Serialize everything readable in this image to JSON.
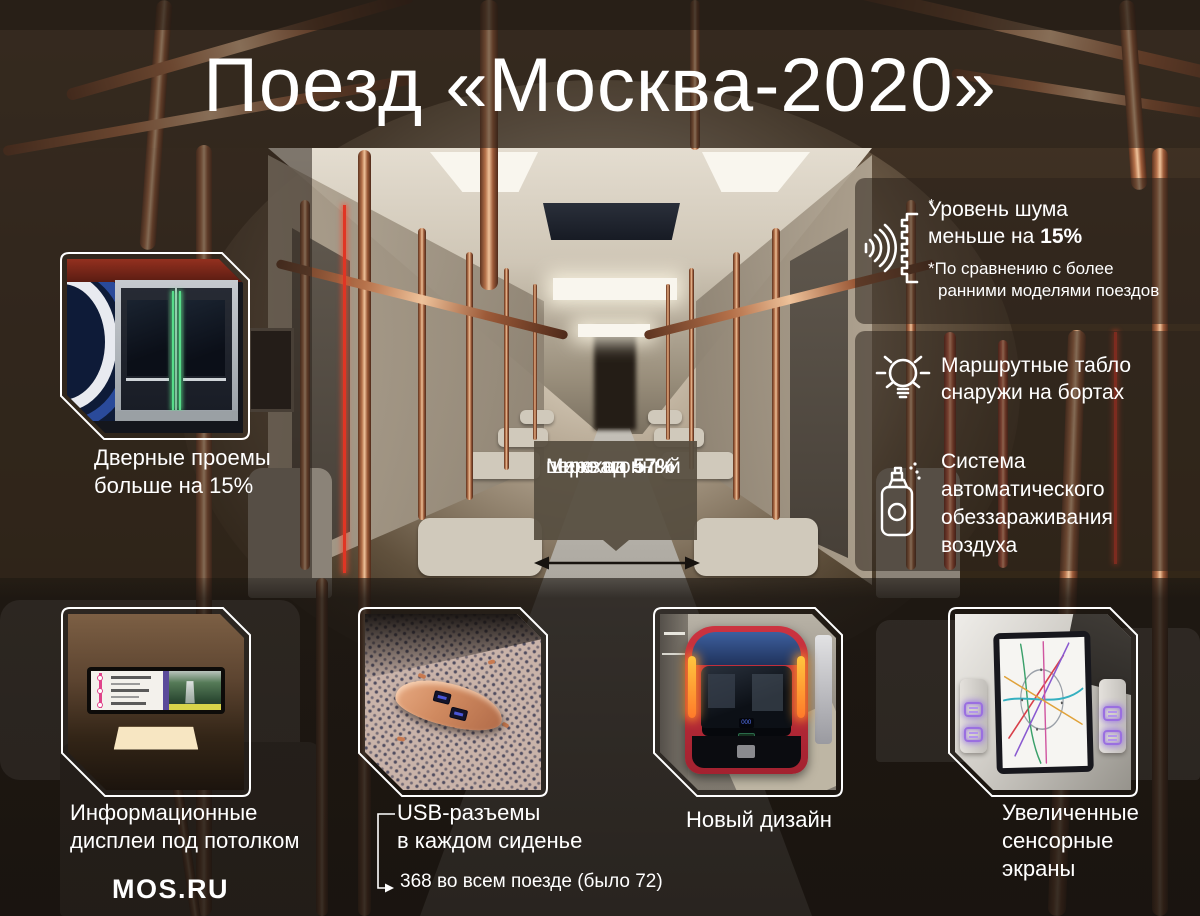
{
  "title": "Поезд «Москва-2020»",
  "brand": {
    "logo": "MOS.RU"
  },
  "callouts": {
    "noise": {
      "line1": "Уровень шума",
      "line2_prefix": "меньше на ",
      "line2_value": "15%",
      "asterisk": "*",
      "footnote1": "*По сравнению с более",
      "footnote2": "ранними моделями поездов"
    },
    "route_boards": {
      "line1": "Маршрутные табло",
      "line2": "снаружи на бортах"
    },
    "air_system": {
      "line1": "Система",
      "line2": "автоматического",
      "line3": "обеззараживания",
      "line4": "воздуха"
    },
    "gangway": {
      "line1": "Межвагонный",
      "line2": "переход",
      "line3_prefix": "шире на ",
      "line3_value": "57%"
    },
    "doors": {
      "line1": "Дверные проемы",
      "line2": "больше на 15%"
    }
  },
  "tiles": {
    "displays": {
      "caption1": "Информационные",
      "caption2": "дисплеи под потолком"
    },
    "usb": {
      "caption1": "USB-разъемы",
      "caption2": "в каждом сиденье",
      "note": "368 во всем поезде (было 72)"
    },
    "design": {
      "caption1": "Новый дизайн",
      "headsign": "000|НЕКРАСОВКА"
    },
    "touchscreens": {
      "caption1": "Увеличенные",
      "caption2": "сенсорные",
      "caption3": "экраны"
    }
  },
  "colors": {
    "copper": "#b97a52",
    "overlay_brown": "#2b231b",
    "gangway_box": "#574e3f",
    "led_green": "#57dd8a",
    "train_red": "#c2303a",
    "usb_purple": "#9a6fe0",
    "arrow_black": "#17130f",
    "route_magenta": "#e0428a"
  }
}
